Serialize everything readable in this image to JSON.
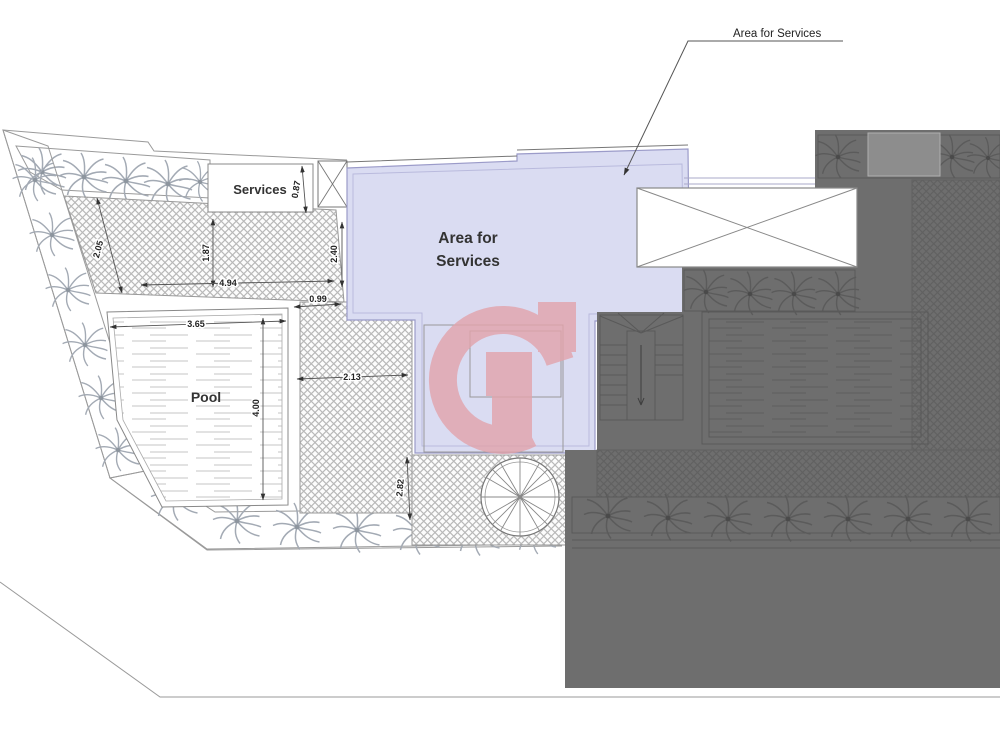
{
  "annotation": {
    "leader_label": "Area for Services"
  },
  "zones": {
    "area_for_services": {
      "line1": "Area for",
      "line2": "Services"
    },
    "services_room": {
      "label": "Services"
    },
    "pool": {
      "label": "Pool"
    }
  },
  "dimensions": {
    "left_terrace_width": "2.05",
    "terrace_height": "1.87",
    "terrace_width": "4.94",
    "terrace_right_height": "2.40",
    "walkway_width": "0.99",
    "services_side": "0.87",
    "pool_width": "3.65",
    "pool_length": "4.00",
    "side_terrace_width": "2.13",
    "stair_court_side": "2.82"
  },
  "symbols": {
    "palm_tree": "palm-tree-icon",
    "spiral_stair": "spiral-staircase-icon",
    "void_box": "crossed-void-icon",
    "watermark": "g-logo-watermark"
  },
  "colors": {
    "services_area_fill": "#dadcf2",
    "services_area_border": "#9b9bc9",
    "neighbor_overlay": "#6e6e6e",
    "watermark_pink": "#e2a3ab",
    "drawing_line": "#8a8a8a"
  }
}
